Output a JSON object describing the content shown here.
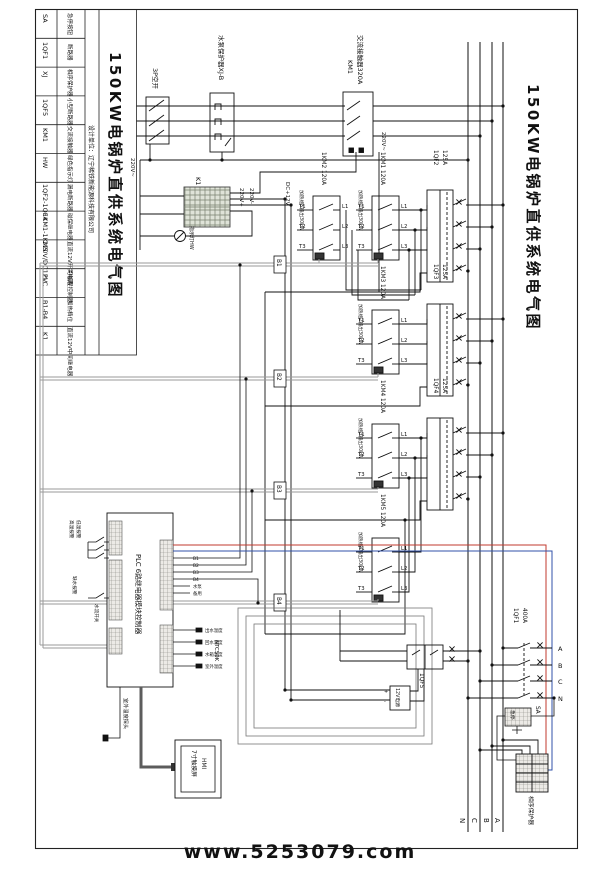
{
  "page": {
    "watermark": "www.5253079.com"
  },
  "title_block": {
    "design_unit": "设计单位：辽宁稀铁新能源科技有限公司",
    "title": "150KW电锅炉直供系统电气图",
    "legend": {
      "codes": [
        "SA",
        "1QF1",
        "XJ",
        "1QF5",
        "KM1",
        "HW",
        "1QF2-1QF4",
        "1KM1-1KM5",
        "220V/DC12V",
        "PLC",
        "B1-B4",
        "K1"
      ],
      "names": [
        "急停按钮",
        "断路器",
        "相序保护器",
        "小型断路器",
        "交流接触器",
        "绿色指示灯",
        "漏电断路器",
        "磁保继电器",
        "直流12V开关电源",
        "可编程控制器",
        "加热档位",
        "直流12V中间继电器"
      ]
    }
  },
  "schematic": {
    "main_title": "150KW电锅炉直供系统电气图",
    "incoming": {
      "switch_3p": "3P空开",
      "pump_protector": "水泵保护器XJ-B",
      "km1_code": "KM1",
      "km1_name": "交流接触器320A",
      "v220_in": "220V~",
      "v220_coil": "220V~"
    },
    "control": {
      "k1": "K1",
      "lamp": "指示灯HW",
      "v220p": "220V+",
      "v220m": "220V-",
      "dc12": "DC+12V",
      "psu": "12V电源",
      "psu_plus": "+",
      "psu_minus": "-",
      "qf5": "1QF5"
    },
    "contactors": [
      {
        "name": "1KM2 120A",
        "heat": "加热组5输出30kW"
      },
      {
        "name": "1KM1 120A",
        "heat": "加热组1输出30kW"
      },
      {
        "name": "1KM3 120A",
        "heat": "加热组2输出30kW"
      },
      {
        "name": "1KM4 120A",
        "heat": "加热组3输出30kW"
      },
      {
        "name": "1KM5 120A",
        "heat": "加热组4输出30kW"
      }
    ],
    "terminals": {
      "t": [
        "T1",
        "T2",
        "T3"
      ],
      "l": [
        "L1",
        "L2",
        "L3"
      ]
    },
    "breakers": [
      {
        "code": "1QF2",
        "rating": "125A"
      },
      {
        "code": "1QF3",
        "rating": "125A"
      },
      {
        "code": "1QF4",
        "rating": "125A"
      }
    ],
    "heat_bus": [
      "B1",
      "B2",
      "B3",
      "B4"
    ],
    "main_breaker": {
      "code": "1QF1",
      "rating": "400A",
      "phases": [
        "A",
        "B",
        "C",
        "N"
      ]
    },
    "bus_bottom": [
      "N",
      "C",
      "B",
      "A"
    ],
    "sa": {
      "code": "SA",
      "label": "急停"
    },
    "phase_protector": "相序保护器",
    "plc": {
      "label": "PLC 6路继电器模块控制器",
      "inputs": [
        "高温报警",
        "低温报警",
        "缺水报警",
        "水流开关"
      ],
      "outputs": [
        "B1",
        "B2",
        "B3",
        "B4",
        "水泵",
        "备用"
      ],
      "ntc": "NTC50K",
      "sensors": [
        "出水温度",
        "回水温度",
        "水箱温度",
        "室外温度"
      ],
      "probe": "室外温度探头"
    },
    "hmi": {
      "line1": "HMI",
      "line2": "7寸触摸屏"
    }
  }
}
